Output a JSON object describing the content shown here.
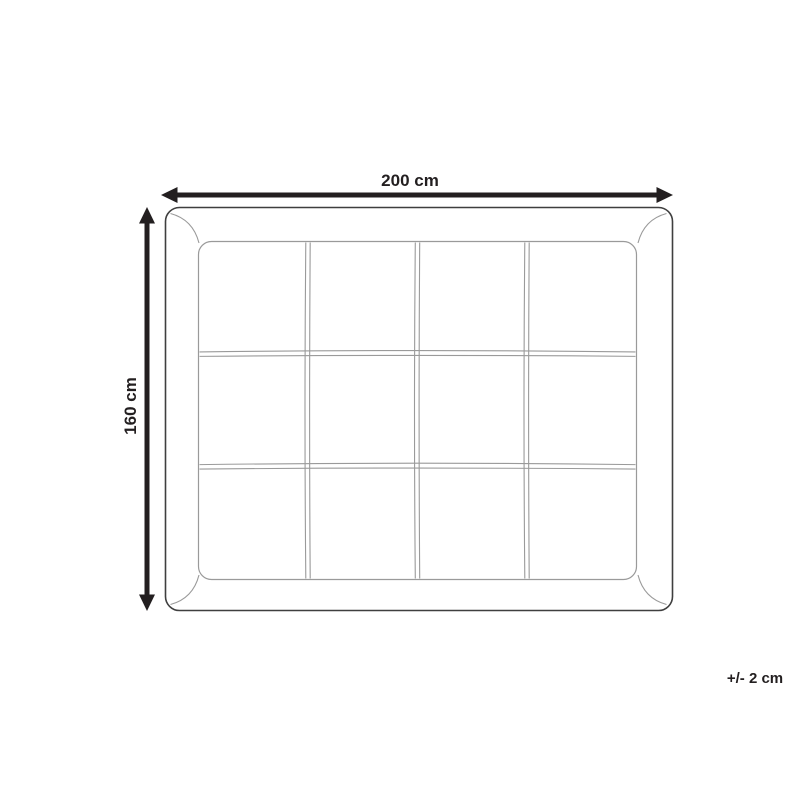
{
  "diagram": {
    "type": "product-dimension-drawing",
    "width_label": "200 cm",
    "height_label": "160 cm",
    "tolerance_label": "+/- 2 cm",
    "grid": {
      "columns": 4,
      "rows": 3
    },
    "colors": {
      "dimension": "#231f20",
      "outline_dark": "#3f3f3f",
      "outline_light": "#9a9a9a",
      "background": "#ffffff"
    }
  }
}
